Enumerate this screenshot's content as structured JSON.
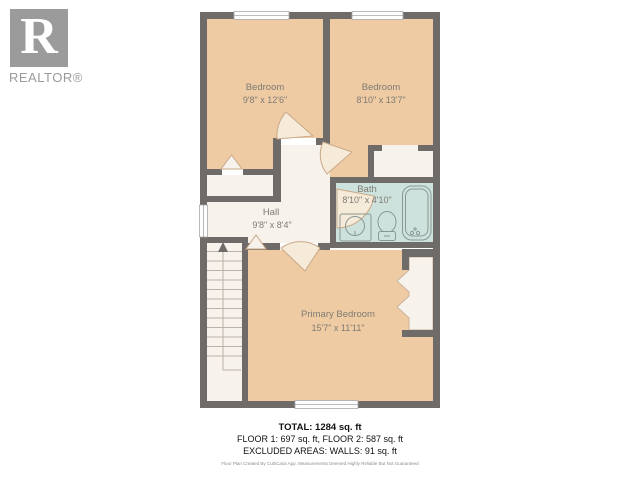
{
  "logo": {
    "letter": "R",
    "brand": "REALTOR®"
  },
  "rooms": {
    "bedroom1": {
      "name": "Bedroom",
      "dims": "9'8\" x 12'6\""
    },
    "bedroom2": {
      "name": "Bedroom",
      "dims": "8'10\" x 13'7\""
    },
    "bath": {
      "name": "Bath",
      "dims": "8'10\" x 4'10\""
    },
    "hall": {
      "name": "Hall",
      "dims": "9'8\" x 8'4\""
    },
    "primary": {
      "name": "Primary Bedroom",
      "dims": "15'7\" x 11'11\""
    }
  },
  "summary": {
    "total": "TOTAL: 1284 sq. ft",
    "floors": "FLOOR 1: 697 sq. ft, FLOOR 2: 587 sq. ft",
    "excluded": "EXCLUDED AREAS: WALLS: 91 sq. ft",
    "disclaimer": "Floor Plan Created By CubiCasa App. Measurements Deemed Highly Reliable But Not Guaranteed"
  },
  "colors": {
    "wall": "#6e6b68",
    "bedroom_floor": "#efcba4",
    "hard_floor": "#f7f2ec",
    "bath_floor": "#cde2dd",
    "door_accent": "#c9a988",
    "label_text": "#7d7b72",
    "logo_gray": "#9b9b9b"
  }
}
